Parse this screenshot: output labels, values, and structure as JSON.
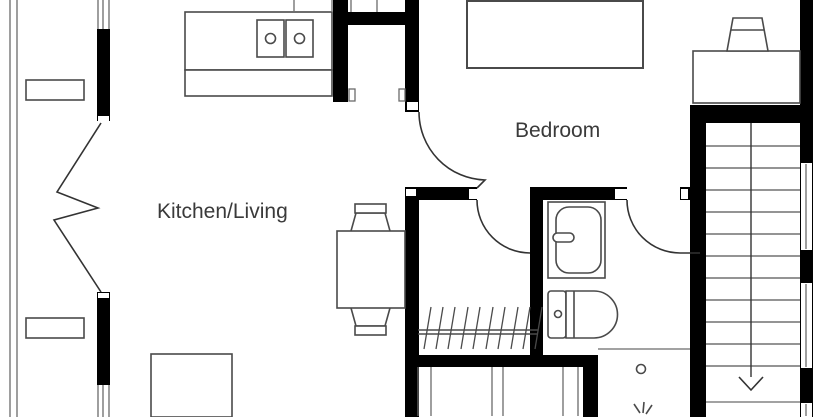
{
  "plan": {
    "type": "floor-plan",
    "rooms": {
      "kitchen_living": {
        "label": "Kitchen/Living"
      },
      "bedroom": {
        "label": "Bedroom"
      }
    },
    "stairs": {
      "direction": "down",
      "treads_visible": 12
    },
    "fixtures": {
      "kitchen": [
        "kitchen-counter",
        "cooktop-2-burner",
        "pantry-closet"
      ],
      "living": [
        "dining-table",
        "dining-chair-top",
        "dining-chair-bottom",
        "sofa"
      ],
      "bedroom": [
        "bed",
        "desk",
        "desk-chair"
      ],
      "walk_in_closet": [
        "hanging-rail",
        "hanger-hatching",
        "storage-cabinets"
      ],
      "bathroom": [
        "washbasin",
        "toilet",
        "shower",
        "shower-drain",
        "shower-spray"
      ],
      "balcony": [
        "folding-doors",
        "planter-box-top",
        "planter-box-bottom",
        "balcony-edge"
      ]
    },
    "colors": {
      "background": "#ffffff",
      "walls": "#000000",
      "lines": "#4a4a4a",
      "thin": "#6b6b6b",
      "doors": "#333333",
      "text": "#3a3a3a"
    }
  }
}
